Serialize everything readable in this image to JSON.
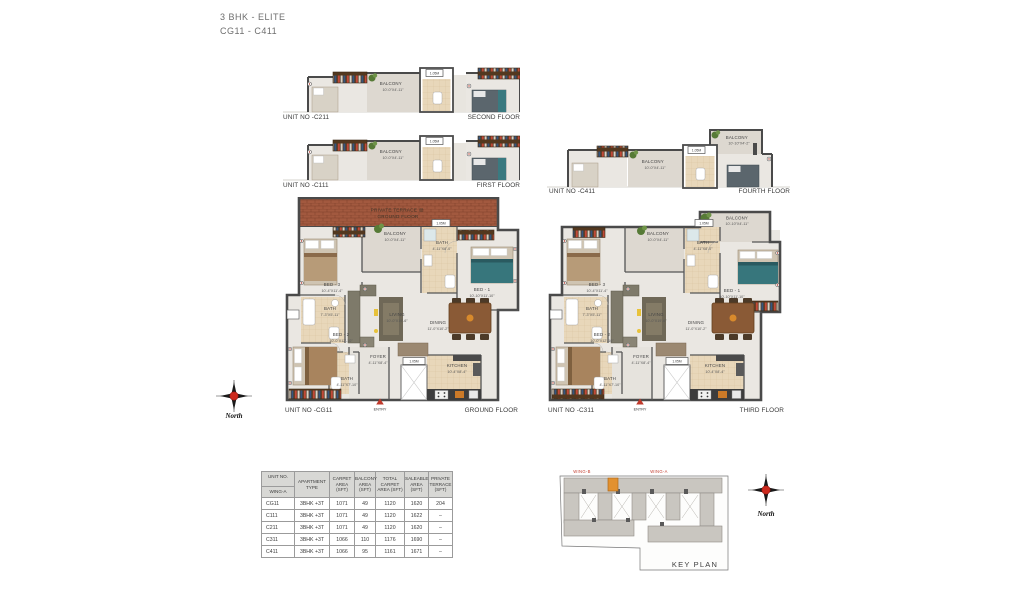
{
  "title": {
    "line1": "3 BHK - ELITE",
    "line2": "CG11 - C411"
  },
  "north_label": "North",
  "key_plan": {
    "label": "KEY PLAN",
    "wing_left": "WING-B",
    "wing_right": "WING-A",
    "highlight_color": "#e2912f"
  },
  "colors": {
    "accent_red": "#c0392b",
    "terrace_brick": "#a2593f",
    "highlight_unit": "#e2912f"
  },
  "floors": {
    "second": {
      "unit": "UNIT NO -C211",
      "floor": "SECOND FLOOR",
      "lift": "1.05M",
      "balcony": {
        "name": "BALCONY",
        "dims": "10'-0\"X4'-11\""
      }
    },
    "first": {
      "unit": "UNIT NO -C111",
      "floor": "FIRST FLOOR",
      "lift": "1.05M",
      "balcony": {
        "name": "BALCONY",
        "dims": "10'-0\"X4'-11\""
      }
    },
    "fourth": {
      "unit": "UNIT NO -C411",
      "floor": "FOURTH FLOOR",
      "lift": "1.05M",
      "balcony": {
        "name": "BALCONY",
        "dims": "10'-0\"X4'-11\""
      },
      "balcony2": {
        "name": "BALCONY",
        "dims": "10'-10\"X4'-2\""
      }
    },
    "ground": {
      "unit": "UNIT NO -CG11",
      "floor": "GROUND FLOOR",
      "entry": "ENTRY",
      "lift": "1.05M",
      "terrace_line1": "PRIVATE TERRACE @",
      "terrace_line2": "GROUND FLOOR",
      "rooms": {
        "bed3": {
          "name": "BED - 3",
          "dims": "10'-4\"X11'-4\""
        },
        "balcony": {
          "name": "BALCONY",
          "dims": "10'-0\"X4'-11\""
        },
        "bath_top": {
          "name": "BATH",
          "dims": "4'-11\"X8'-0\""
        },
        "bed1": {
          "name": "BED - 1",
          "dims": "10'-10\"X11'-10\""
        },
        "bath_mid": {
          "name": "BATH",
          "dims": "7'-3\"X5'-11\""
        },
        "bed2": {
          "name": "BED - 2",
          "dims": "10'-0\"X12'-10\""
        },
        "living": {
          "name": "LIVING",
          "dims": "10'-0\"X19'-6\""
        },
        "dining": {
          "name": "DINING",
          "dims": "11'-0\"X10'-2\""
        },
        "foyer": {
          "name": "FOYER",
          "dims": "4'-11\"X8'-4\""
        },
        "bath_low": {
          "name": "BATH",
          "dims": "4'-11\"X7'-10\""
        },
        "kitchen": {
          "name": "KITCHEN",
          "dims": "10'-4\"X8'-4\""
        }
      }
    },
    "third": {
      "unit": "UNIT NO -C311",
      "floor": "THIRD FLOOR",
      "entry": "ENTRY",
      "lift": "1.05M",
      "rooms": {
        "bed3": {
          "name": "BED - 3",
          "dims": "10'-4\"X11'-4\""
        },
        "balcony": {
          "name": "BALCONY",
          "dims": "10'-0\"X4'-11\""
        },
        "balcony2": {
          "name": "BALCONY",
          "dims": "10'-10\"X4'-11\""
        },
        "bath_top": {
          "name": "BATH",
          "dims": "4'-11\"X8'-0\""
        },
        "bed1": {
          "name": "BED - 1",
          "dims": "10'-10\"X11'-10\""
        },
        "bath_mid": {
          "name": "BATH",
          "dims": "7'-3\"X5'-11\""
        },
        "bed2": {
          "name": "BED - 2",
          "dims": "10'-0\"X12'-10\""
        },
        "living": {
          "name": "LIVING",
          "dims": "10'-0\"X19'-6\""
        },
        "dining": {
          "name": "DINING",
          "dims": "11'-0\"X10'-2\""
        },
        "foyer": {
          "name": "FOYER",
          "dims": "4'-11\"X8'-4\""
        },
        "bath_low": {
          "name": "BATH",
          "dims": "4'-11\"X7'-10\""
        },
        "kitchen": {
          "name": "KITCHEN",
          "dims": "10'-4\"X8'-4\""
        }
      }
    }
  },
  "table": {
    "headers": [
      [
        "UNIT NO.",
        "WING-A"
      ],
      [
        "APARTMENT",
        "TYPE"
      ],
      [
        "CARPET",
        "AREA",
        "(SFT)"
      ],
      [
        "BALCONY",
        "AREA",
        "(SFT)"
      ],
      [
        "TOTAL",
        "CARPET",
        "AREA (SFT)"
      ],
      [
        "SALEABLE",
        "AREA",
        "(SFT)"
      ],
      [
        "PRIVATE",
        "TERRACE",
        "(SFT)"
      ]
    ],
    "rows": [
      [
        "CG11",
        "3BHK +3T",
        "1071",
        "49",
        "1120",
        "1620",
        "204"
      ],
      [
        "C111",
        "3BHK +3T",
        "1071",
        "49",
        "1120",
        "1622",
        "–"
      ],
      [
        "C211",
        "3BHK +3T",
        "1071",
        "49",
        "1120",
        "1620",
        "–"
      ],
      [
        "C311",
        "3BHK +3T",
        "1066",
        "110",
        "1176",
        "1690",
        "–"
      ],
      [
        "C411",
        "3BHK +3T",
        "1066",
        "95",
        "1161",
        "1671",
        "–"
      ]
    ]
  }
}
